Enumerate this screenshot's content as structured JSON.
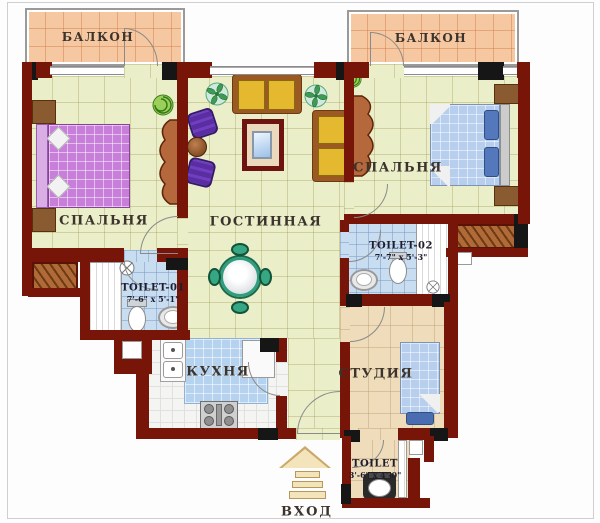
{
  "title": "Apartment floor plan",
  "rooms": {
    "balcony_left": {
      "label": "БАЛКОН"
    },
    "balcony_right": {
      "label": "БАЛКОН"
    },
    "bedroom_left": {
      "label": "СПАЛЬНЯ"
    },
    "bedroom_right": {
      "label": "СПАЛЬНЯ"
    },
    "living_room": {
      "label": "ГОСТИННАЯ"
    },
    "kitchen": {
      "label": "КУХНЯ"
    },
    "studio": {
      "label": "СТУДИЯ"
    },
    "toilet_01": {
      "label": "TOILET-01",
      "dimensions": "7'-6\" x 5'-1\""
    },
    "toilet_02": {
      "label": "TOILET-02",
      "dimensions": "7'-7\" x 5'-3\""
    },
    "toilet_03": {
      "label": "TOILET",
      "dimensions": "3'-6\" x 4'-0\""
    },
    "entrance": {
      "label": "ВХОД"
    }
  },
  "colors": {
    "wall": "#771509",
    "wall_accent": "#161616",
    "floor_main": "#eaeec9",
    "floor_balcony": "#f6c8a2",
    "floor_bath": "#c9ddf1",
    "floor_kitchen": "#f4f4f2",
    "floor_studio": "#eedcba",
    "bed_left": "#c77fd9",
    "bed_right": "#b7cfec",
    "sofa": "#e5b92f",
    "armchair": "#5a2da2",
    "dining_chair": "#35a883",
    "counter": "#b5d2ee"
  }
}
